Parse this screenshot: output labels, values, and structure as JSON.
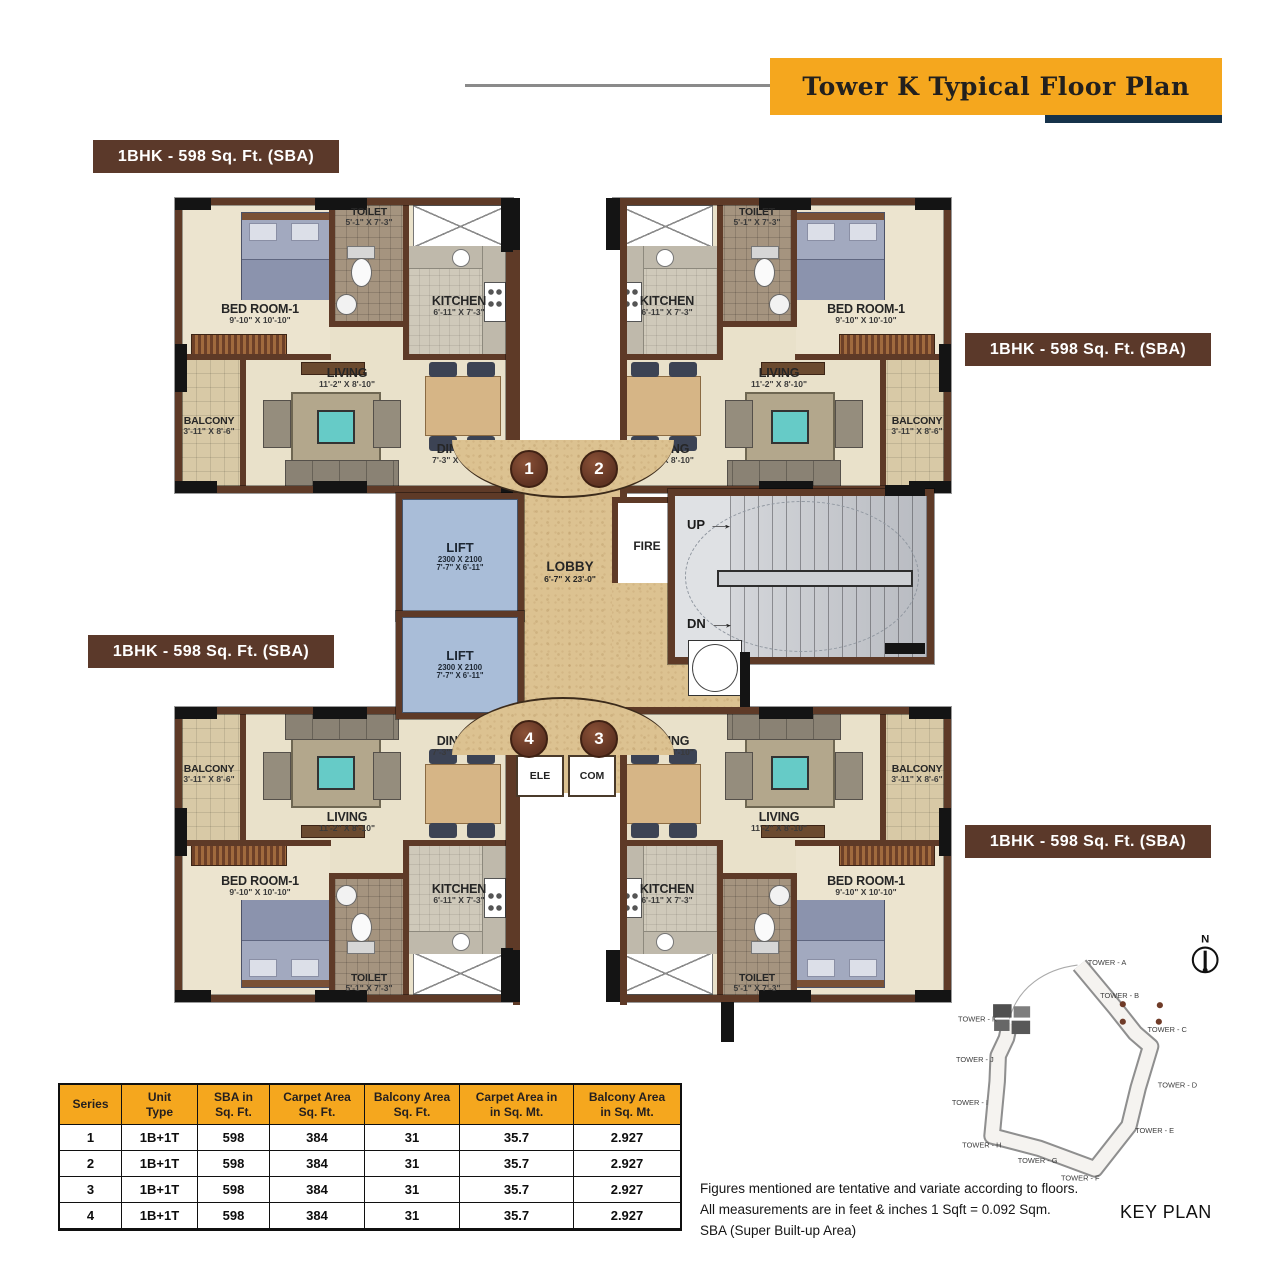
{
  "banner": {
    "title": "Tower  K  Typical Floor Plan"
  },
  "unit_label": "1BHK - 598 Sq. Ft. (SBA)",
  "rooms": {
    "bedroom": {
      "name": "BED ROOM-1",
      "dims": "9'-10\" X 10'-10\""
    },
    "toilet": {
      "name": "TOILET",
      "dims": "5'-1\" X 7'-3\""
    },
    "kitchen": {
      "name": "KITCHEN",
      "dims": "6'-11\" X 7'-3\""
    },
    "living": {
      "name": "LIVING",
      "dims": "11'-2\" X 8'-10\""
    },
    "dining": {
      "name": "DINING",
      "dims": "7'-3\" X 8'-10\""
    },
    "balcony": {
      "name": "BALCONY",
      "dims": "3'-11\" X 8'-6\""
    }
  },
  "core": {
    "lift": {
      "name": "LIFT",
      "size_mm": "2300 X 2100",
      "size_ft": "7'-7\" X 6'-11\""
    },
    "lobby": {
      "name": "LOBBY",
      "dims": "6'-7\" X 23'-0\""
    },
    "fire": "FIRE",
    "up": "UP",
    "dn": "DN",
    "ele": "ELE",
    "com": "COM",
    "markers": {
      "m1": "1",
      "m2": "2",
      "m3": "3",
      "m4": "4"
    }
  },
  "table": {
    "headers": [
      "Series",
      "Unit\nType",
      "SBA  in\nSq. Ft.",
      "Carpet Area\nSq. Ft.",
      "Balcony Area\nSq. Ft.",
      "Carpet Area in\nin Sq. Mt.",
      "Balcony Area\nin Sq. Mt."
    ],
    "rows": [
      [
        "1",
        "1B+1T",
        "598",
        "384",
        "31",
        "35.7",
        "2.927"
      ],
      [
        "2",
        "1B+1T",
        "598",
        "384",
        "31",
        "35.7",
        "2.927"
      ],
      [
        "3",
        "1B+1T",
        "598",
        "384",
        "31",
        "35.7",
        "2.927"
      ],
      [
        "4",
        "1B+1T",
        "598",
        "384",
        "31",
        "35.7",
        "2.927"
      ]
    ]
  },
  "notes": [
    "Figures mentioned are tentative and variate according to floors.",
    "All measurements are in feet & inches 1 Sqft = 0.092 Sqm.",
    "SBA (Super Built-up Area)"
  ],
  "key_plan": {
    "label": "KEY PLAN",
    "north": "N",
    "towers": [
      "TOWER - A",
      "TOWER - B",
      "TOWER - C",
      "TOWER - D",
      "TOWER - E",
      "TOWER - F",
      "TOWER - G",
      "TOWER - H",
      "TOWER - I",
      "TOWER - J",
      "TOWER - K"
    ]
  },
  "colors": {
    "wall": "#5e3a27",
    "floor": "#e9e1ca",
    "lift": "#a9bdd8",
    "lobby": "#dcc291",
    "accent_orange": "#f5a71e",
    "label_brown": "#5b392a",
    "navy": "#16324a"
  }
}
